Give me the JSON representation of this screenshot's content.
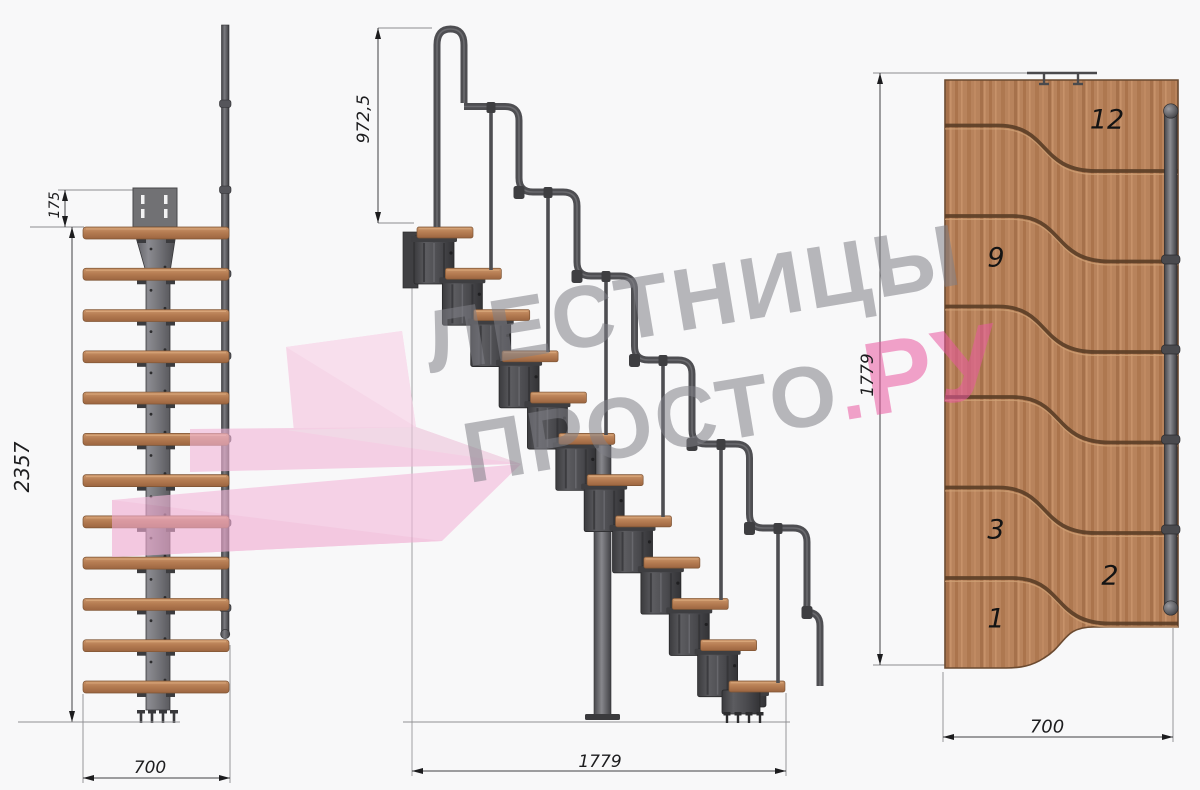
{
  "watermark": {
    "line1": "ЛЕСТНИЦЫ",
    "line2": "ПРОСТО",
    "dot": ".",
    "suffix": "РУ"
  },
  "front_view": {
    "dims": {
      "plate_offset": "175",
      "total_height": "2357",
      "width": "700"
    }
  },
  "side_view": {
    "dims": {
      "handrail_height": "972,5",
      "length": "1779"
    }
  },
  "plan_view": {
    "dims": {
      "length": "1779",
      "width": "700"
    },
    "step_numbers": [
      "12",
      "9",
      "3",
      "2",
      "1"
    ]
  },
  "colors": {
    "background": "#f8f8f9",
    "wood": "#b9835c",
    "metal": "#4a4a4d",
    "watermark_gray": "#b9b9bc",
    "accent_pink": "#ef9ec6"
  }
}
